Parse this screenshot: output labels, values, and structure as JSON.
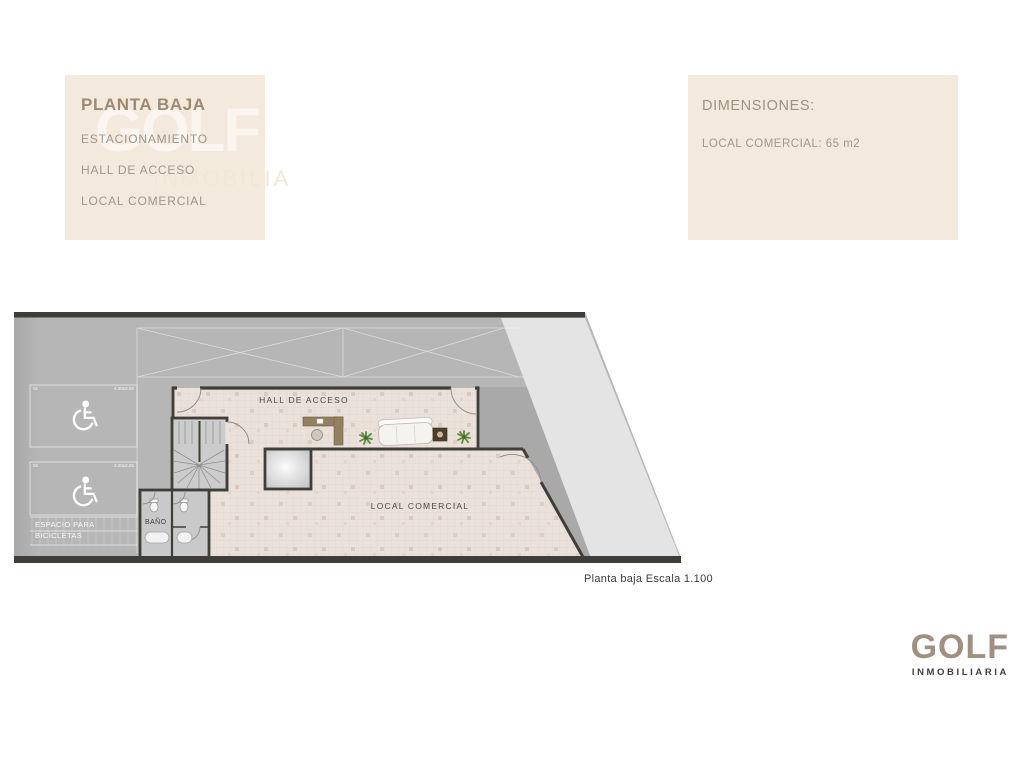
{
  "legend_box": {
    "title": "PLANTA BAJA",
    "items": [
      "ESTACIONAMIENTO",
      "HALL DE ACCESO",
      "LOCAL COMERCIAL"
    ]
  },
  "dimensions_box": {
    "title": "DIMENSIONES:",
    "detail": "LOCAL COMERCIAL: 65 m2"
  },
  "watermark": {
    "big": "GOLF",
    "small": "INMOBILIA"
  },
  "plan": {
    "rooms": {
      "hall": "HALL DE ACCESO",
      "local": "LOCAL COMERCIAL",
      "bathroom": "BAÑO"
    },
    "bike_area": {
      "line1": "ESPACIO PARA",
      "line2": "BICICLETAS"
    },
    "parking_stalls": [
      {
        "number": "01",
        "dimension": "4.30x3.25"
      },
      {
        "number": "02",
        "dimension": "4.30x3.25"
      }
    ],
    "caption": "Planta baja Escala 1.100"
  },
  "logo": {
    "name": "GOLF",
    "subtitle": "INMOBILIARIA"
  },
  "colors": {
    "panel_beige": "#f3e9dc",
    "legend_title_brown": "#9c8a73",
    "panel_text_gray": "#a0968c",
    "plan_gray": "#b5b6b5",
    "plan_light_gray": "#e3e4e3",
    "plan_shadow_gray": "#a8a9a8",
    "floor_pink": "#ebe1db",
    "wall_dark": "#403e39",
    "logo_taupe": "#a09080",
    "logo_dark": "#3f3f3f"
  }
}
